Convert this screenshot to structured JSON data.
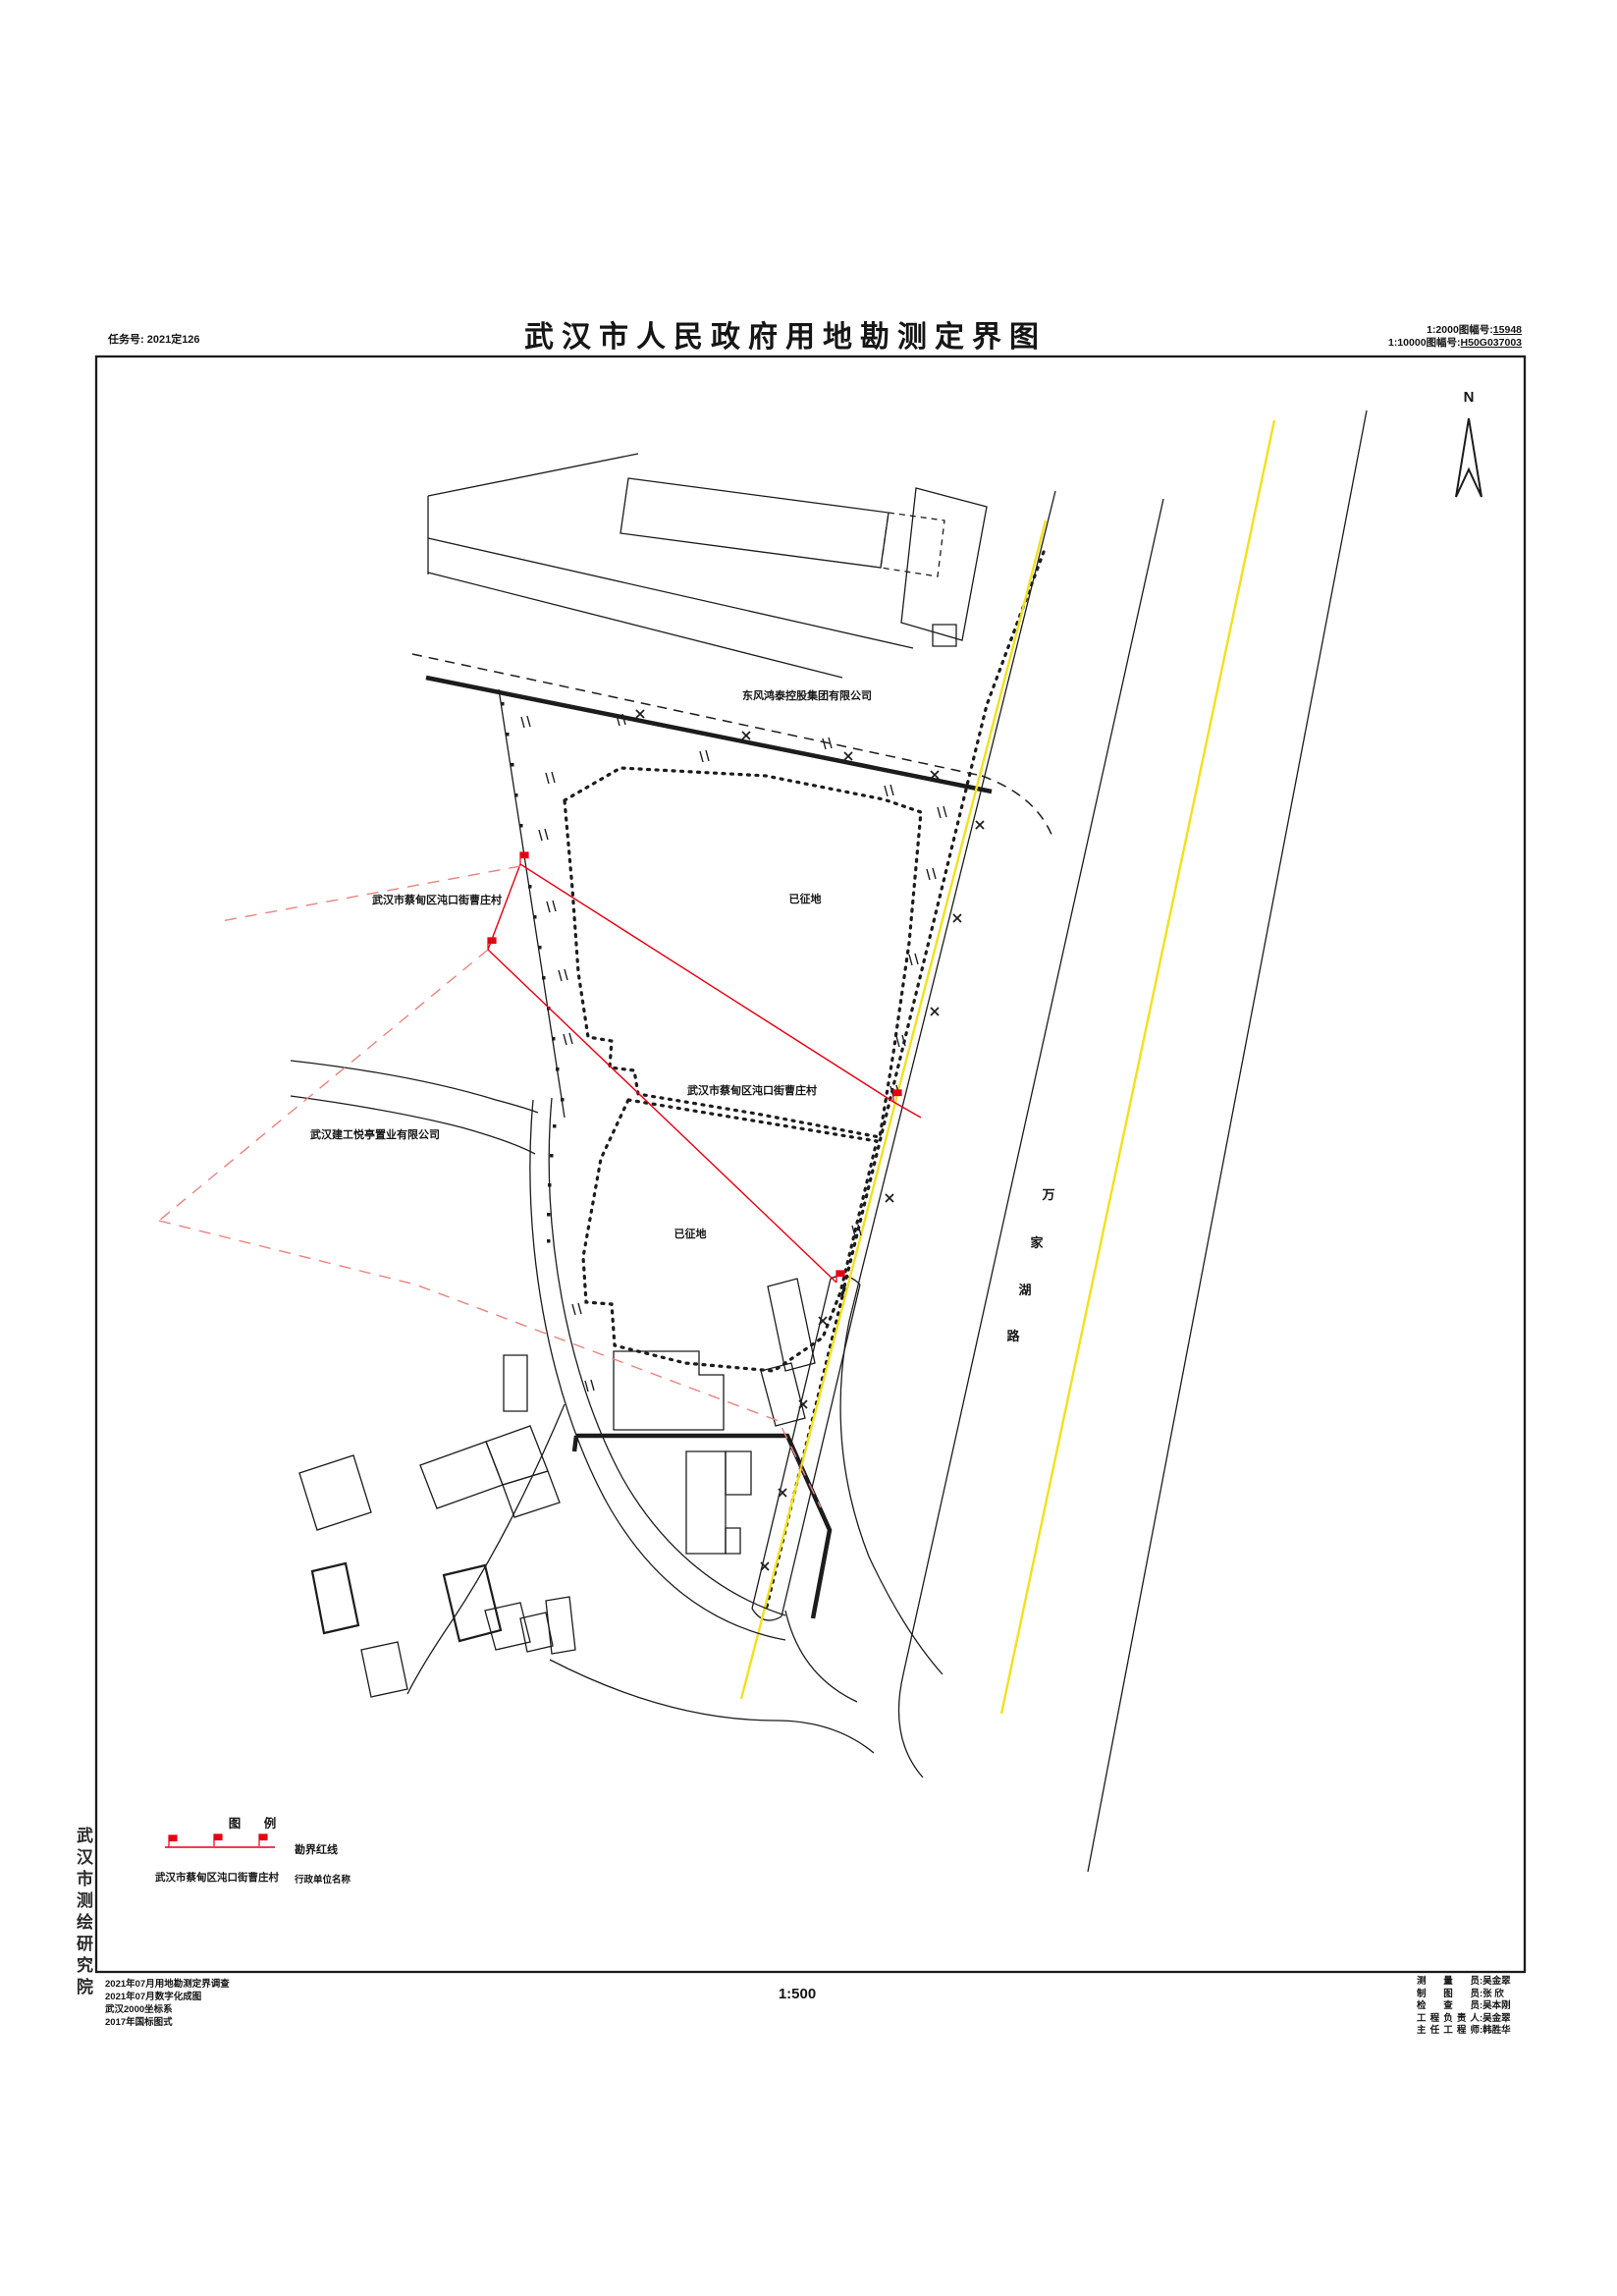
{
  "header": {
    "task_no": "任务号: 2021定126",
    "title": "武汉市人民政府用地勘测定界图",
    "sheet_2000_label": "1:2000图幅号:",
    "sheet_2000_no": "15948",
    "sheet_10000_label": "1:10000图幅号:",
    "sheet_10000_no": "H50G037003",
    "north_label": "N"
  },
  "map_labels": {
    "company_top": "东风鸿泰控股集团有限公司",
    "village_left": "武汉市蔡甸区沌口街曹庄村",
    "village_center": "武汉市蔡甸区沌口街曹庄村",
    "company_left": "武汉建工悦亭置业有限公司",
    "area1": "已征地",
    "area2": "已征地",
    "road": [
      "万",
      "家",
      "湖",
      "路"
    ]
  },
  "legend": {
    "title": "图 例",
    "redline_label": "勘界红线",
    "admin_name": "武汉市蔡甸区沌口街曹庄村",
    "admin_label": "行政单位名称"
  },
  "notes": [
    "2021年07月用地勘测定界调查",
    "2021年07月数字化成图",
    "武汉2000坐标系",
    "2017年国标图式"
  ],
  "footer": {
    "scale": "1:500",
    "agency": "武汉市测绘研究院"
  },
  "colon": ":",
  "credits": [
    {
      "role": "测 量 员",
      "name": "吴金翠"
    },
    {
      "role": "制 图 员",
      "name": "张 欣"
    },
    {
      "role": "检 查 员",
      "name": "吴本刚"
    },
    {
      "role": "工程负责人",
      "name": "吴金翠"
    },
    {
      "role": "主任工程师",
      "name": "韩胜华"
    }
  ],
  "colors": {
    "ink": "#1c1c1c",
    "red": "#e60012",
    "red_d": "#e8837f",
    "yellow": "#f2e11c"
  }
}
